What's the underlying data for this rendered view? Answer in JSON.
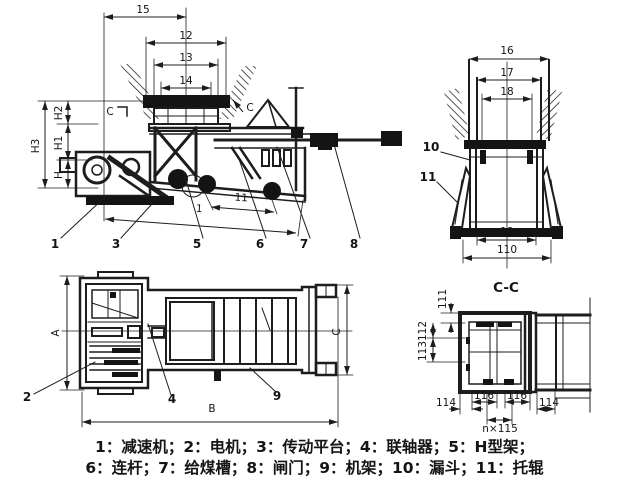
{
  "drawing": {
    "side_view": {
      "dims": {
        "d15": "15",
        "d12": "12",
        "d13": "13",
        "d14": "14",
        "dH3": "H3",
        "dH2": "H2",
        "dH1": "H1",
        "dH": "H",
        "d11": "11",
        "dl": "1"
      },
      "section_mark_left": "C",
      "section_mark_right": "C",
      "parts": {
        "p1": "1",
        "p3": "3",
        "p5": "5",
        "p6": "6",
        "p7": "7",
        "p8": "8"
      }
    },
    "end_view": {
      "dims": {
        "d16": "16",
        "d17": "17",
        "d18": "18",
        "d19": "19",
        "d110": "110"
      },
      "parts": {
        "p10": "10",
        "p11": "11"
      }
    },
    "plan_view": {
      "dims": {
        "dA": "A",
        "dB": "B",
        "dC": "C"
      },
      "parts": {
        "p2": "2",
        "p4": "4",
        "p9": "9"
      }
    },
    "section_view": {
      "title": "C-C",
      "dims": {
        "d111": "111",
        "d112": "112",
        "d113": "113",
        "d114L": "114",
        "d116L": "116",
        "d116R": "116",
        "d114R": "114",
        "d115": "n×115"
      }
    }
  },
  "legend": {
    "line1": "1：减速机；2：电机；3：传动平台；4：联轴器；5：H型架；",
    "line2": "6：连杆；7：给煤槽；8：闸门；9：机架；10：漏斗；11：托辊"
  }
}
